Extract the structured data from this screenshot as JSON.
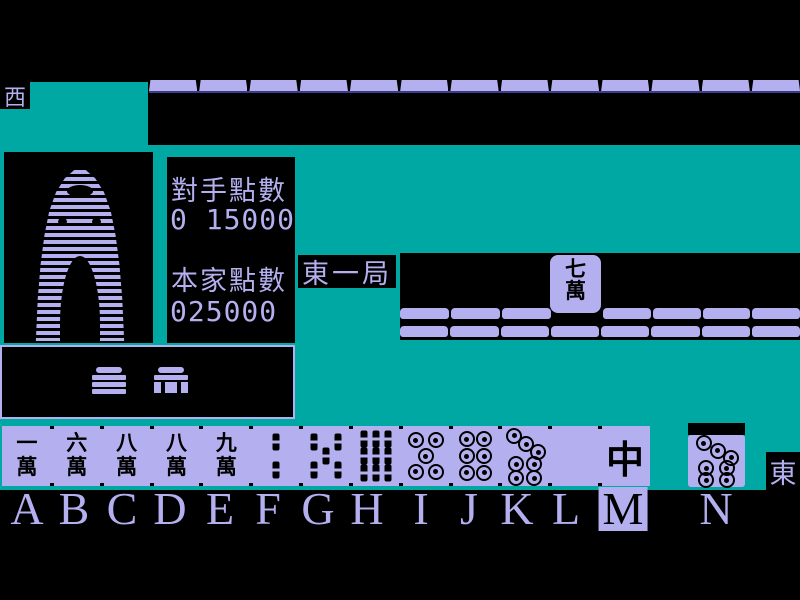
{
  "palette": {
    "teal": "#00A8A4",
    "lavender": "#B4B0F0",
    "navy": "#3C3C8C",
    "black": "#000000"
  },
  "winds": {
    "left_indicator": "西",
    "right_indicator": "東"
  },
  "round_label": "東一局",
  "score_panel": {
    "opponent_label": "對手點數",
    "opponent_value": "0 15000",
    "self_label": "本家點數",
    "self_value": "025000"
  },
  "opponent_discard_tile": {
    "top_char": "七",
    "bottom_char": "萬",
    "name": "7-man"
  },
  "walls": {
    "top_row_segments": 13,
    "discard_row1_left_segments": 3,
    "discard_row1_right_segments": 4,
    "discard_row2_segments": 8
  },
  "hand": {
    "tiles": [
      {
        "letter": "A",
        "suit": "man",
        "top": "一",
        "bottom": "萬",
        "name": "1-man"
      },
      {
        "letter": "B",
        "suit": "man",
        "top": "六",
        "bottom": "萬",
        "name": "6-man"
      },
      {
        "letter": "C",
        "suit": "man",
        "top": "八",
        "bottom": "萬",
        "name": "8-man"
      },
      {
        "letter": "D",
        "suit": "man",
        "top": "八",
        "bottom": "萬",
        "name": "8-man"
      },
      {
        "letter": "E",
        "suit": "man",
        "top": "九",
        "bottom": "萬",
        "name": "9-man"
      },
      {
        "letter": "F",
        "suit": "sou",
        "count": 2,
        "name": "2-sou"
      },
      {
        "letter": "G",
        "suit": "sou",
        "count": 5,
        "name": "5-sou"
      },
      {
        "letter": "H",
        "suit": "sou",
        "count": 9,
        "name": "9-sou"
      },
      {
        "letter": "I",
        "suit": "pin",
        "count": 5,
        "name": "5-pin"
      },
      {
        "letter": "J",
        "suit": "pin",
        "count": 6,
        "name": "6-pin"
      },
      {
        "letter": "K",
        "suit": "pin",
        "count": 7,
        "name": "7-pin"
      },
      {
        "letter": "L",
        "suit": "blank",
        "name": "white-dragon"
      },
      {
        "letter": "M",
        "suit": "honor",
        "glyph": "中",
        "name": "red-dragon",
        "selected": true
      }
    ],
    "drawn_tile": {
      "letter": "N",
      "suit": "pin",
      "count": 7,
      "name": "7-pin"
    }
  },
  "letters": [
    {
      "ch": "A"
    },
    {
      "ch": "B"
    },
    {
      "ch": "C"
    },
    {
      "ch": "D"
    },
    {
      "ch": "E"
    },
    {
      "ch": "F"
    },
    {
      "ch": "G"
    },
    {
      "ch": "H"
    },
    {
      "ch": "I"
    },
    {
      "ch": "J"
    },
    {
      "ch": "K"
    },
    {
      "ch": "L"
    },
    {
      "ch": "M",
      "selected": true
    },
    {
      "ch": "N"
    }
  ],
  "selected_letter": "M"
}
